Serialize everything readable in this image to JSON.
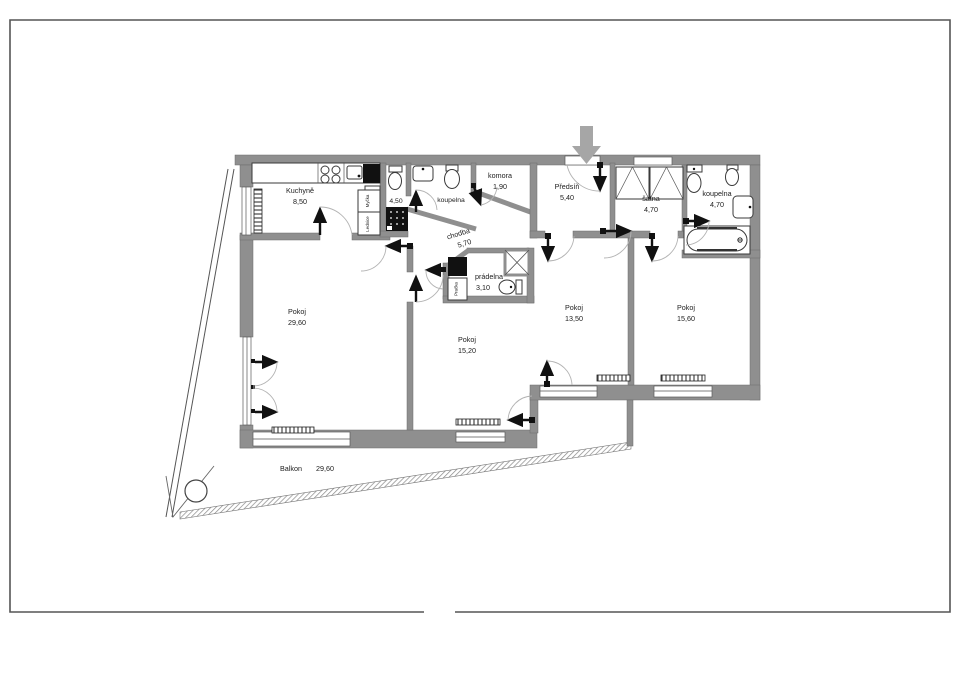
{
  "page": {
    "type": "apartment-floor-plan",
    "background": "#ffffff",
    "border_color": "#555555",
    "wall_color": "#8f8f8f",
    "fixture_color": "#111111",
    "entry_arrow_color": "#a6a6a6",
    "text_color": "#1c1c1c"
  },
  "rooms": {
    "kuchyne": {
      "name": "Kuchyně",
      "area": "8,50"
    },
    "wc_shower": {
      "name": "",
      "area": "4,50"
    },
    "koupelna_mid": {
      "name": "koupelna",
      "area": ""
    },
    "komora": {
      "name": "komora",
      "area": "1,90"
    },
    "predsin": {
      "name": "Předsíň",
      "area": "5,40"
    },
    "satna": {
      "name": "šatna",
      "area": "4,70"
    },
    "koupelna_top": {
      "name": "koupelna",
      "area": "4,70"
    },
    "chodba": {
      "name": "chodba",
      "area": "5,70"
    },
    "pradelna": {
      "name": "prádelna",
      "area": "3,10"
    },
    "pokoj_a": {
      "name": "Pokoj",
      "area": "29,60"
    },
    "pokoj_b": {
      "name": "Pokoj",
      "area": "15,20"
    },
    "pokoj_c": {
      "name": "Pokoj",
      "area": "13,50"
    },
    "pokoj_d": {
      "name": "Pokoj",
      "area": "15,60"
    },
    "balkon": {
      "name": "Balkon",
      "area": "29,60"
    }
  },
  "appliances": {
    "dishwasher": "Myčka",
    "fridge": "Lednice",
    "washer": "Pračka"
  },
  "fixtures": [
    "stove-icon",
    "kitchen-sink-icon",
    "oven-icon",
    "shower-icon",
    "toilet-icon",
    "washbasin-icon",
    "bidet-icon",
    "bathtub-icon",
    "washing-machine-icon",
    "wardrobe-icon",
    "radiator-icon",
    "ventilation-shaft-icon",
    "entrance-arrow-icon",
    "balcony-column-icon"
  ]
}
